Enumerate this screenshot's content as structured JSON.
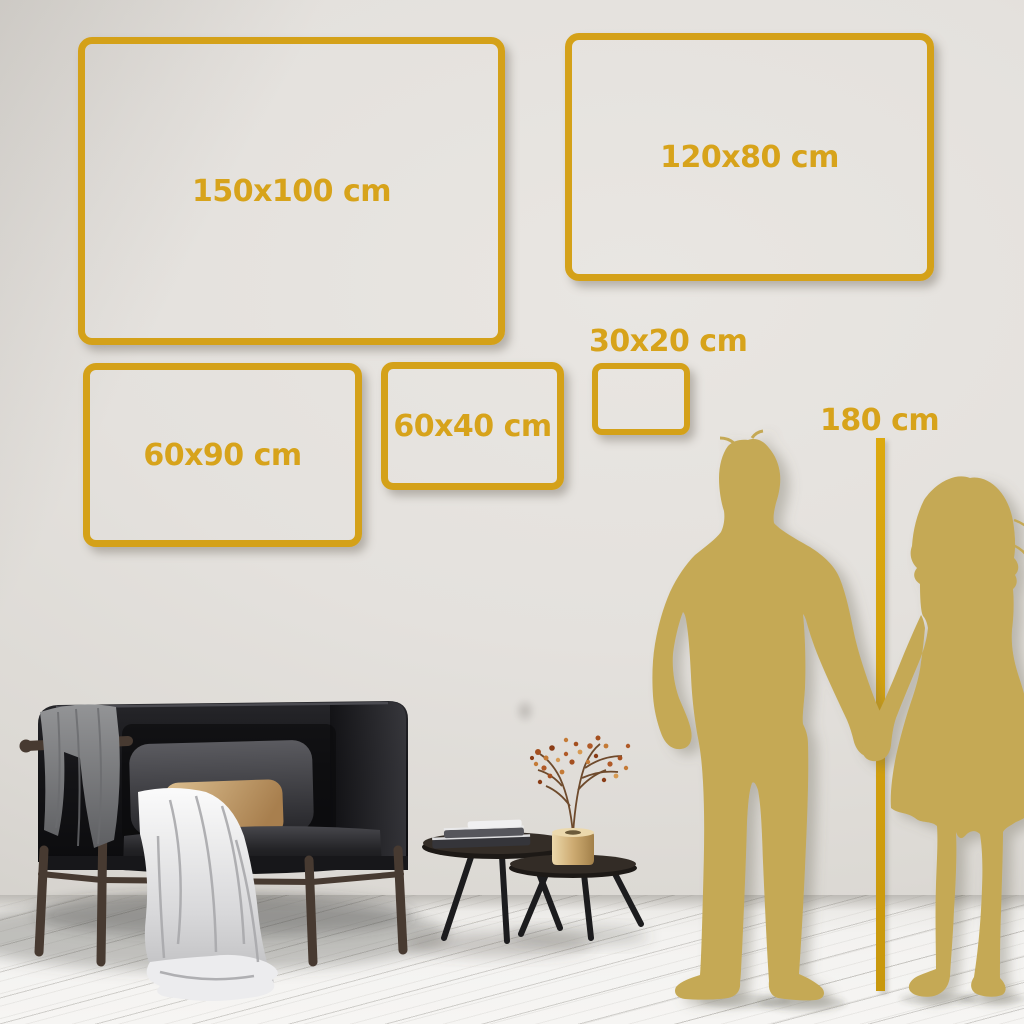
{
  "colors": {
    "accent_gold": "#D4A119",
    "silhouette_gold": "#C5A955",
    "wall_gray": "#E4E1DD",
    "floor_white": "#F3F2F0"
  },
  "size_frames": [
    {
      "id": "150x100",
      "label": "150x100 cm"
    },
    {
      "id": "120x80",
      "label": "120x80 cm"
    },
    {
      "id": "60x90",
      "label": "60x90 cm"
    },
    {
      "id": "60x40",
      "label": "60x40 cm"
    },
    {
      "id": "30x20",
      "label": "30x20 cm"
    }
  ],
  "height_marker": {
    "label": "180 cm"
  },
  "scene_objects": {
    "wall": "plain light-gray wall",
    "floor": "white-washed wood plank floor",
    "sofa": "dark charcoal loveseat with wood frame",
    "gray_pillow": "dark gray back pillow",
    "tan_pillow": "tan lumbar pillow",
    "dark_throw": "gray blanket over left armrest",
    "light_throw": "light gray blanket cascading to floor",
    "tables": "two dark nesting coffee tables",
    "books": "stack of books on tall table",
    "vase": "brass vase with dried rust-colored branch",
    "silhouettes": "gold couple silhouette holding hands at 180 cm line"
  }
}
